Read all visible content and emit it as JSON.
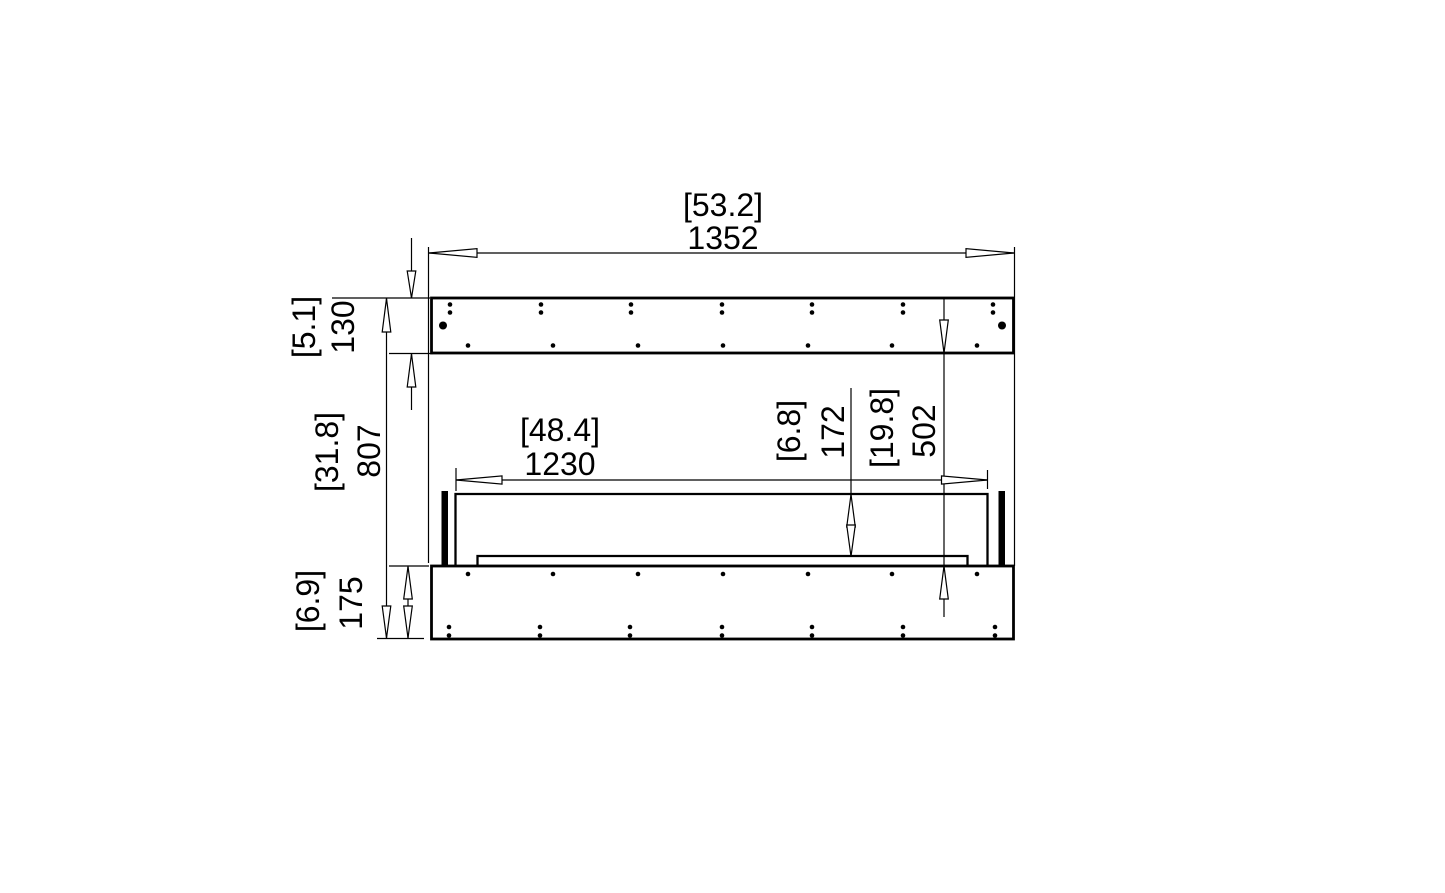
{
  "page": {
    "background": "#ffffff",
    "line_color": "#000000"
  },
  "drawing": {
    "type": "technical-dimension-drawing",
    "subject": "fireplace-insert-front-elevation",
    "units": {
      "bracketed": "inches",
      "plain": "millimetres"
    },
    "labels": {
      "overall_width_in": "[53.2]",
      "overall_width_mm": "1352",
      "top_flange_in": "[5.1]",
      "top_flange_mm": "130",
      "overall_height_in": "[31.8]",
      "overall_height_mm": "807",
      "firebox_width_in": "[48.4]",
      "firebox_width_mm": "1230",
      "firebox_height_in": "[6.8]",
      "firebox_height_mm": "172",
      "opening_height_in": "[19.8]",
      "opening_height_mm": "502",
      "base_height_in": "[6.9]",
      "base_height_mm": "175"
    }
  }
}
